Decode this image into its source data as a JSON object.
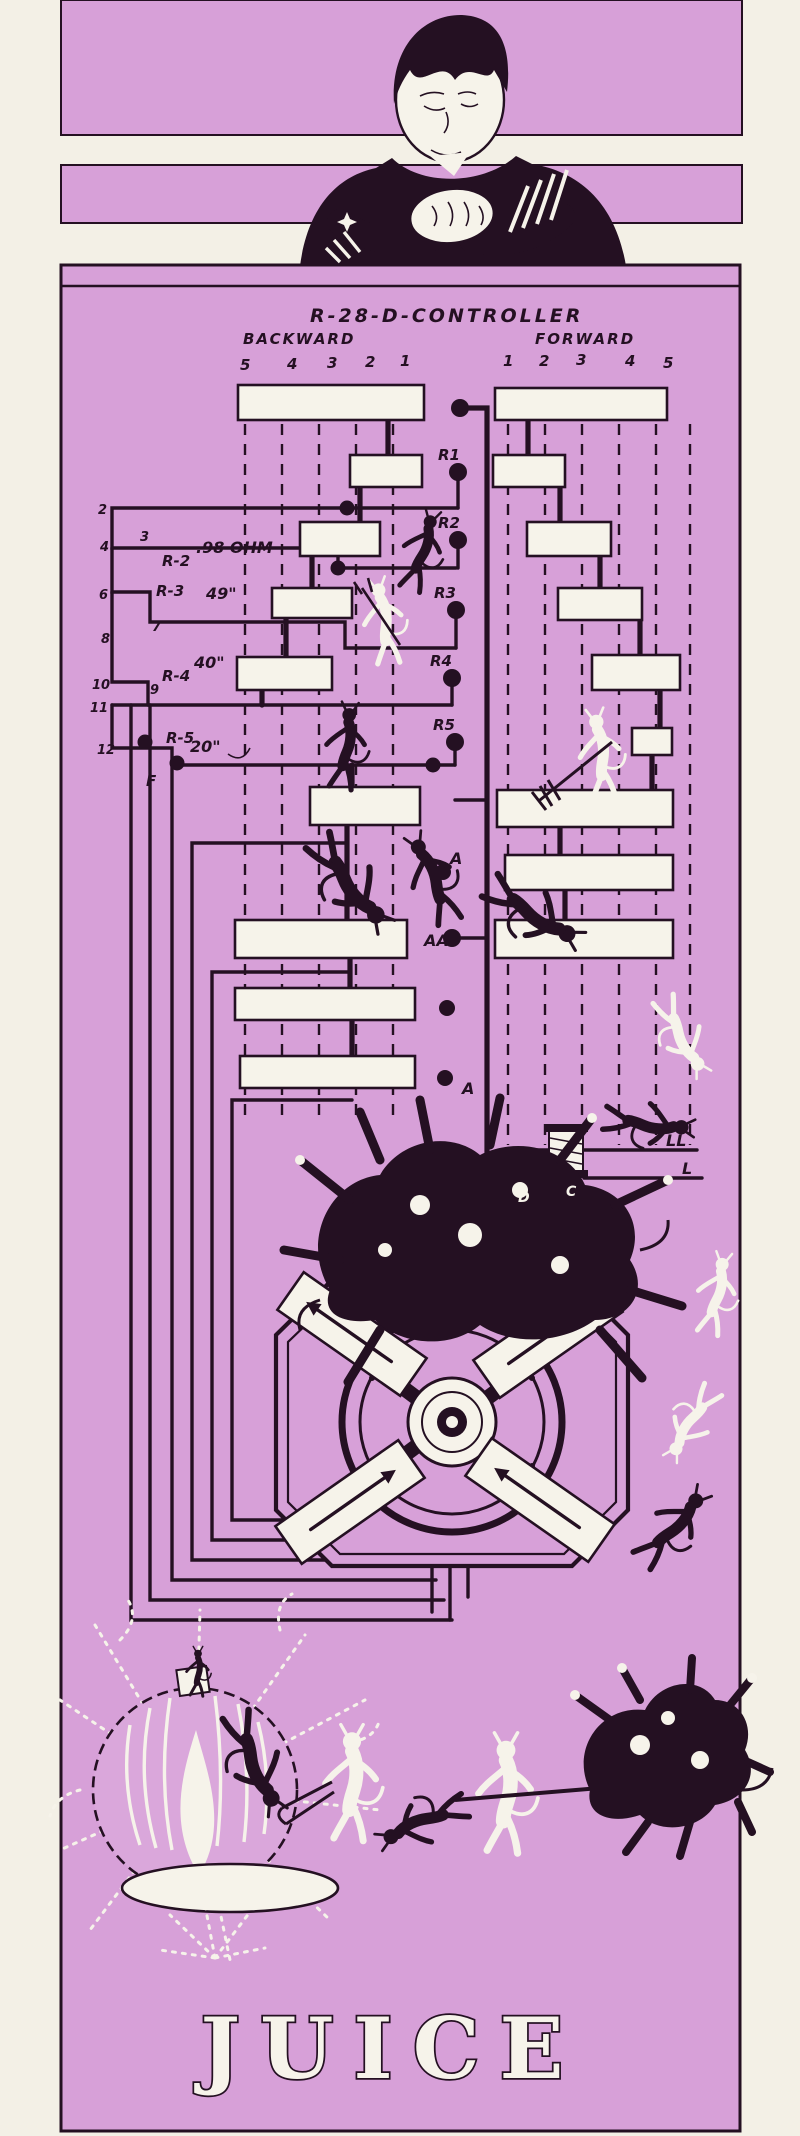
{
  "colors": {
    "paper": "#f3f0e6",
    "panel_lilac": "#d7a0d8",
    "ink_black": "#241022",
    "highlight_white": "#f6f3ea"
  },
  "header": {
    "title": "R-28-D-CONTROLLER",
    "backward": "BACKWARD",
    "forward": "FORWARD",
    "backward_positions": [
      "5",
      "4",
      "3",
      "2",
      "1"
    ],
    "forward_positions": [
      "1",
      "2",
      "3",
      "4",
      "5"
    ]
  },
  "bank": {
    "t2": "2",
    "t4": "4",
    "t3": "3",
    "t6": "6",
    "t7": "7",
    "t8": "8",
    "t10": "10",
    "t9": "9",
    "t11": "11",
    "t12": "12",
    "r2_name": "R-2",
    "r2_value": ".98 OHM",
    "r3_name": "R-3",
    "r3_value": "49\"",
    "r4_name": "R-4",
    "r4_value": "40\"",
    "r5_name": "R-5",
    "r5_value": "20\"",
    "feeder": "F"
  },
  "taps": {
    "r1": "R1",
    "r2": "R2",
    "r3": "R3",
    "r4": "R4",
    "r5": "R5"
  },
  "points": {
    "a_upper": "A",
    "aa": "AA",
    "a_lower": "A"
  },
  "inductor": {
    "upper": "LL",
    "lower": "L"
  },
  "imp_letters": {
    "d": "D",
    "c": "C"
  },
  "caption": "JUICE"
}
